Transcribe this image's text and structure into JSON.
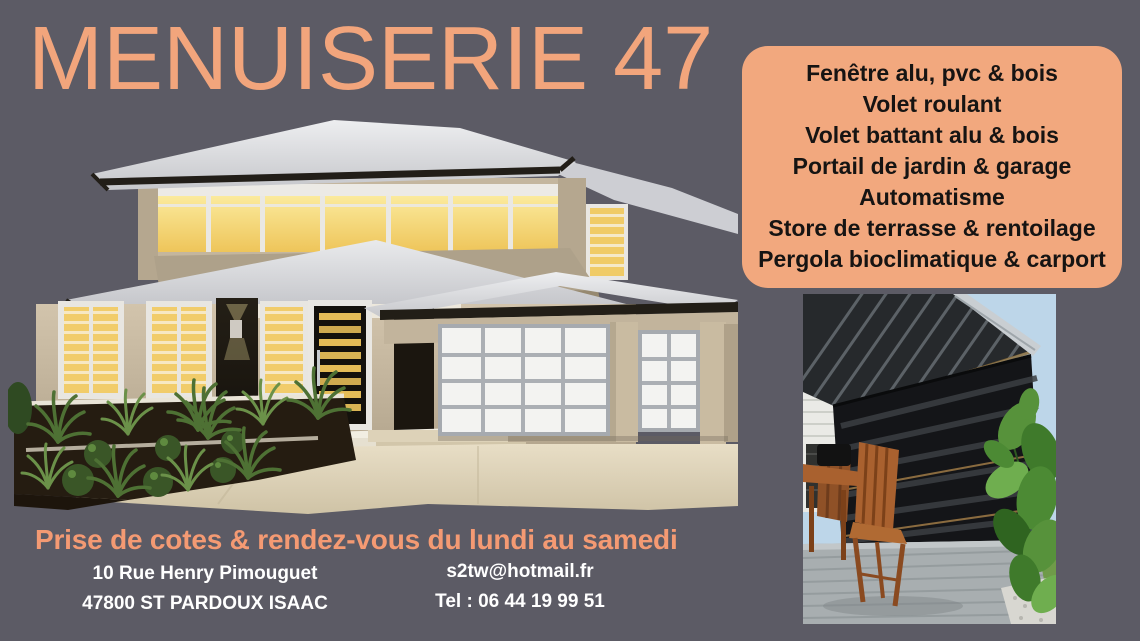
{
  "page": {
    "background_color": "#5C5B65",
    "accent_color": "#F2A57C",
    "box_color": "#F2A87E",
    "box_text_color": "#161413",
    "footer_text_color": "#FFFFFF"
  },
  "header": {
    "business_name": "MENUISERIE 47"
  },
  "services_box": {
    "items": [
      "Fenêtre alu, pvc & bois",
      "Volet roulant",
      "Volet battant alu & bois",
      "Portail de jardin & garage",
      "Automatisme",
      "Store de terrasse & rentoilage",
      "Pergola bioclimatique & carport"
    ]
  },
  "footer": {
    "tagline": "Prise de cotes & rendez-vous du lundi au samedi",
    "address_line1": "10 Rue Henry Pimouguet",
    "address_line2": "47800 ST PARDOUX ISAAC",
    "email": "s2tw@hotmail.fr",
    "phone": "Tel : 06 44 19 99 51"
  }
}
